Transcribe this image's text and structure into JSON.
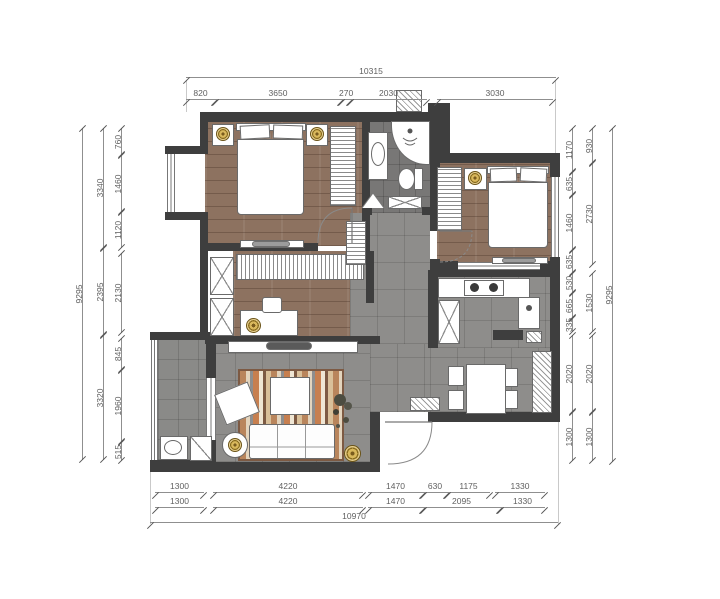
{
  "dimensions": {
    "top": {
      "overall": "10315",
      "segments": [
        "820",
        "3650",
        "270",
        "2030",
        "3030"
      ]
    },
    "bottom": {
      "overall": "10970",
      "inner": [
        "1300",
        "4220",
        "1470",
        "630",
        "1175",
        "1330"
      ],
      "middle": [
        "1300",
        "4220",
        "1470",
        "2095",
        "1330"
      ]
    },
    "left": {
      "overall": "9295",
      "middle": [
        "3340",
        "2395",
        "3320"
      ],
      "inner": [
        "760",
        "1460",
        "1120",
        "2130",
        "845",
        "1960",
        "515"
      ]
    },
    "right": {
      "overall": "9295",
      "middle": [
        "930",
        "2730",
        "1530",
        "2020",
        "1300"
      ],
      "inner": [
        "1170",
        "635",
        "1460",
        "635",
        "530",
        "665",
        "335",
        "2020",
        "1300"
      ]
    }
  },
  "colors": {
    "wall": "#3e3e3e",
    "wood_floor": "#8d7260",
    "tile_floor": "#8e8d8b",
    "bath_tile": "#787776",
    "balcony_tile": "#8a8a88",
    "rug_accent": "#c77f4f",
    "gold_decor": "#d9b85c",
    "dimension_text": "#5f5f5f"
  }
}
